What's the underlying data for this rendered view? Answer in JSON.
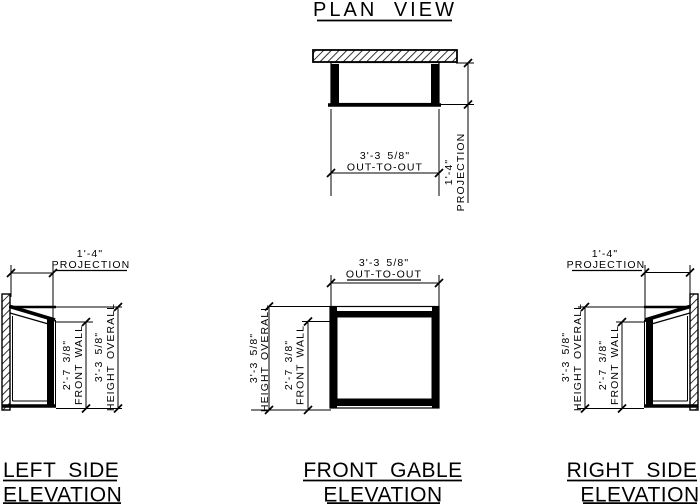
{
  "colors": {
    "ink": "#000000",
    "paper": "#ffffff"
  },
  "plan": {
    "title": "PLAN VIEW",
    "dims": {
      "out_to_out": {
        "value": "3'-3 5/8\"",
        "label": "OUT-TO-OUT"
      },
      "projection": {
        "value": "1'-4\"",
        "label": "PROJECTION"
      }
    }
  },
  "left_elevation": {
    "title_line1": "LEFT SIDE",
    "title_line2": "ELEVATION",
    "dims": {
      "projection": {
        "value": "1'-4\"",
        "label": "PROJECTION"
      },
      "front_wall": {
        "value": "2'-7 3/8\"",
        "label": "FRONT WALL"
      },
      "height_overall": {
        "value": "3'-3 5/8\"",
        "label": "HEIGHT OVERALL"
      }
    }
  },
  "front_elevation": {
    "title_line1": "FRONT GABLE",
    "title_line2": "ELEVATION",
    "dims": {
      "out_to_out": {
        "value": "3'-3 5/8\"",
        "label": "OUT-TO-OUT"
      },
      "front_wall": {
        "value": "2'-7 3/8\"",
        "label": "FRONT WALL"
      },
      "height_overall": {
        "value": "3'-3 5/8\"",
        "label": "HEIGHT OVERALL"
      }
    }
  },
  "right_elevation": {
    "title_line1": "RIGHT SIDE",
    "title_line2": "ELEVATION",
    "dims": {
      "projection": {
        "value": "1'-4\"",
        "label": "PROJECTION"
      },
      "front_wall": {
        "value": "2'-7 3/8\"",
        "label": "FRONT WALL"
      },
      "height_overall": {
        "value": "3'-3 5/8\"",
        "label": "HEIGHT OVERALL"
      }
    }
  }
}
